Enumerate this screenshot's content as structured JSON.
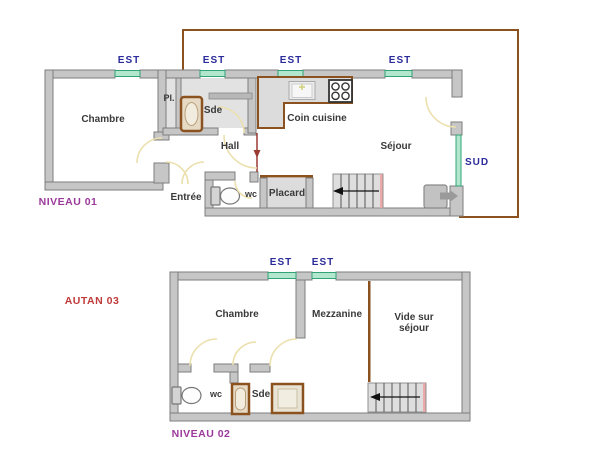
{
  "colors": {
    "wall_fill": "#c6c6c6",
    "wall_stroke": "#7d7d7d",
    "room_fill_light": "#e2e2e2",
    "roof_outline_brown": "#8b5220",
    "window_green_fill": "#b2e6cd",
    "window_green_border": "#33a377",
    "direction_text_blue": "#2b2b9b",
    "level_text_purple": "#9b3a9b",
    "plan_ref_red": "#c03a3a",
    "door_arc_cream": "#ece0ae",
    "stair_edge_pink": "#eba9a9",
    "entry_arrow_red": "#9c3a32"
  },
  "level1": {
    "title": "NIVEAU 01",
    "est_labels": [
      "EST",
      "EST",
      "EST",
      "EST"
    ],
    "sud_label": "SUD",
    "rooms": {
      "chambre": "Chambre",
      "pl": "Pl.",
      "sde": "Sde",
      "coin_cuisine": "Coin cuisine",
      "hall": "Hall",
      "sejour": "Séjour",
      "entree": "Entrée",
      "wc": "wc",
      "placard": "Placard"
    }
  },
  "level2": {
    "title": "NIVEAU 02",
    "plan_reference": "AUTAN 03",
    "est_labels": [
      "EST",
      "EST"
    ],
    "rooms": {
      "chambre": "Chambre",
      "mezzanine": "Mezzanine",
      "vide_sur_sejour": "Vide sur séjour",
      "wc": "wc",
      "sde": "Sde"
    }
  }
}
